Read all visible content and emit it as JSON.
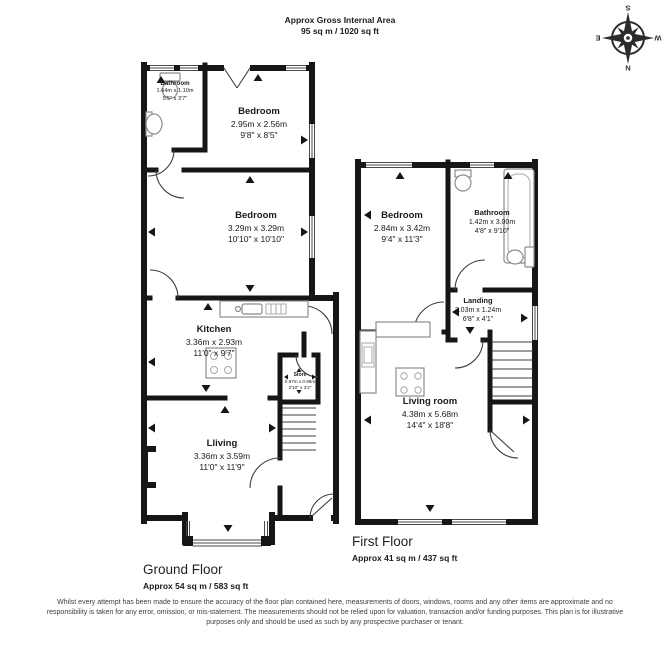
{
  "header": {
    "line1": "Approx Gross Internal Area",
    "line2": "95 sq m / 1020 sq ft"
  },
  "compass": {
    "n": "N",
    "e": "E",
    "s": "S",
    "w": "W"
  },
  "floors": {
    "ground": {
      "name": "Ground Floor",
      "area": "Approx 54 sq m / 583 sq ft",
      "rooms": [
        {
          "name": "Bathroom",
          "metric": "1.64m x 1.10m",
          "imperial": "5'5\" x 3'7\""
        },
        {
          "name": "Bedroom",
          "metric": "2.95m x 2.56m",
          "imperial": "9'8\" x 8'5\""
        },
        {
          "name": "Bedroom",
          "metric": "3.29m x 3.29m",
          "imperial": "10'10\" x 10'10\""
        },
        {
          "name": "Kitchen",
          "metric": "3.36m x 2.93m",
          "imperial": "11'0\" x 9'7\""
        },
        {
          "name": "Store",
          "metric": "0.87m x 0.98m",
          "imperial": "2'10\" x 3'2\""
        },
        {
          "name": "Lliving",
          "metric": "3.36m x 3.59m",
          "imperial": "11'0\" x 11'9\""
        }
      ]
    },
    "first": {
      "name": "First Floor",
      "area": "Approx 41 sq m / 437 sq ft",
      "rooms": [
        {
          "name": "Bedroom",
          "metric": "2.84m x 3.42m",
          "imperial": "9'4\" x 11'3\""
        },
        {
          "name": "Bathroom",
          "metric": "1.42m x 3.00m",
          "imperial": "4'8\" x 9'10\""
        },
        {
          "name": "Landing",
          "metric": "2.03m x 1.24m",
          "imperial": "6'8\" x 4'1\""
        },
        {
          "name": "Living room",
          "metric": "4.38m x 5.68m",
          "imperial": "14'4\" x 18'8\""
        }
      ]
    }
  },
  "colors": {
    "wall": "#161616",
    "thin_line": "#3d3d3d",
    "text": "#1a1a1a"
  },
  "disclaimer": "Whilst every attempt has been made to ensure the accuracy of the floor plan contained here, measurements of doors, windows, rooms and any other items are approximate and no responsibility is taken for any error, omission, or mis-statement. The measurements should not be relied upon for valuation, transaction and/or funding purposes. This plan is for illustrative purposes only and should be used as such by any prospective purchaser or tenant."
}
